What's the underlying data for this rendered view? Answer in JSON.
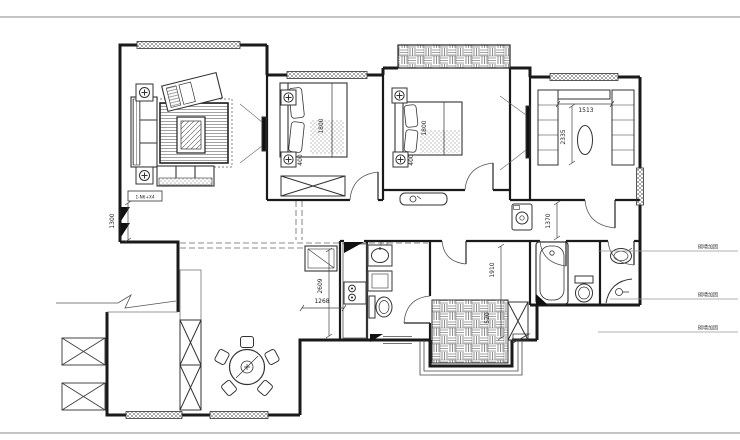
{
  "plan": {
    "dimensions": {
      "living_wall": "1300",
      "bed1_length": "1800",
      "bed1_nightstand": "400",
      "bed2_length": "1800",
      "bed2_nightstand": "400",
      "study_width": "1513",
      "study_depth": "2335",
      "kitchen_depth": "2609",
      "kitchen_width": "1268",
      "bath_hall_depth": "1370",
      "laundry_depth": "1910",
      "laundry_width": "520"
    },
    "annotations": {
      "wall_note_1": "砌墙加固",
      "wall_note_2": "砌墙加固",
      "wall_note_3": "砌墙加固",
      "detail_tag": "1-N6+X4"
    },
    "colors": {
      "ink": "#1a1a1a",
      "frame_gray": "#8a8a8a"
    }
  }
}
